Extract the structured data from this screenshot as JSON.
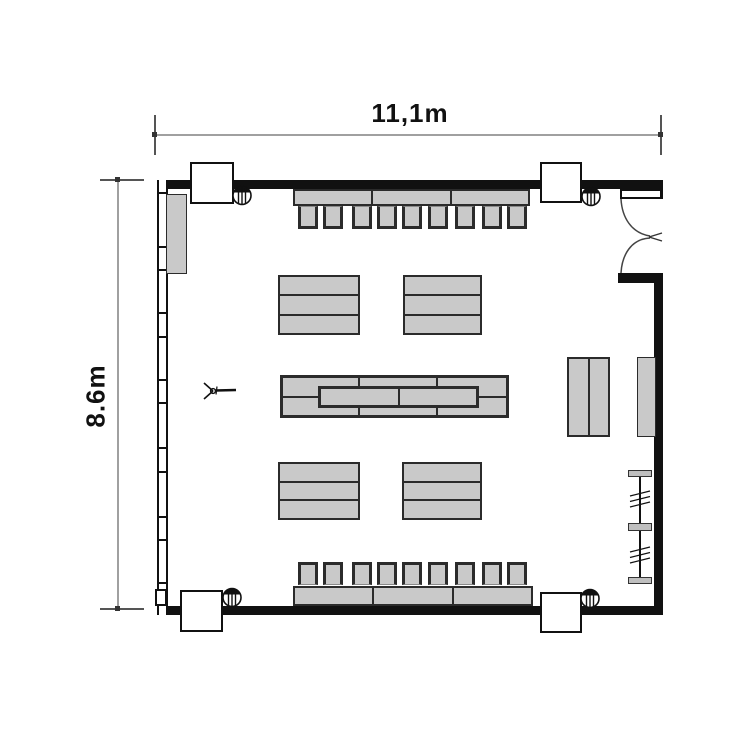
{
  "dimensions": {
    "width_label": "11,1m",
    "height_label": "8.6m"
  },
  "colors": {
    "wall": "#111111",
    "furniture-fill": "#c9c9c9",
    "furniture-border": "#2b2b2b",
    "dim-line": "#a0a0a0",
    "dim-tick": "#555555",
    "bg": "#ffffff",
    "text": "#111111"
  },
  "inventory": {
    "wall_tables_top_row": 3,
    "chairs_top_row": 9,
    "wall_tables_bottom_row": 3,
    "chairs_bottom_row": 9,
    "stacked_table_groups": 4,
    "center_table_stack_rows": 2,
    "corner_columns": 4,
    "corner_speakers": 4,
    "side_cabinets_right": 2,
    "coat_rack": 1,
    "left_cabinet": 1,
    "double_door": 1
  }
}
